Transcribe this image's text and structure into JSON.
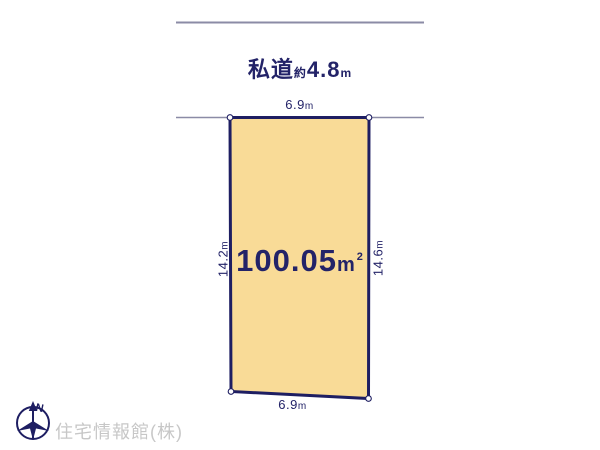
{
  "canvas": {
    "width": 600,
    "height": 450,
    "background": "#ffffff"
  },
  "colors": {
    "plot_fill": "#f9db97",
    "plot_border": "#1e1e62",
    "text_navy": "#232368",
    "boundary_line_gray": "#8b8ba6",
    "watermark_gray": "#c7c7c7"
  },
  "road": {
    "label": "私道",
    "approx": "約",
    "value": "4.8",
    "unit": "m"
  },
  "plot": {
    "area": {
      "value": "100.05",
      "unit": "m",
      "unit_sup": "2"
    },
    "dimensions": {
      "top": {
        "value": "6.9",
        "unit": "m"
      },
      "bottom": {
        "value": "6.9",
        "unit": "m"
      },
      "left": {
        "value": "14.2",
        "unit": "m"
      },
      "right": {
        "value": "14.6",
        "unit": "m"
      }
    }
  },
  "compass": {
    "north_label": "N"
  },
  "footer": {
    "company": "住宅情報館(株)"
  }
}
